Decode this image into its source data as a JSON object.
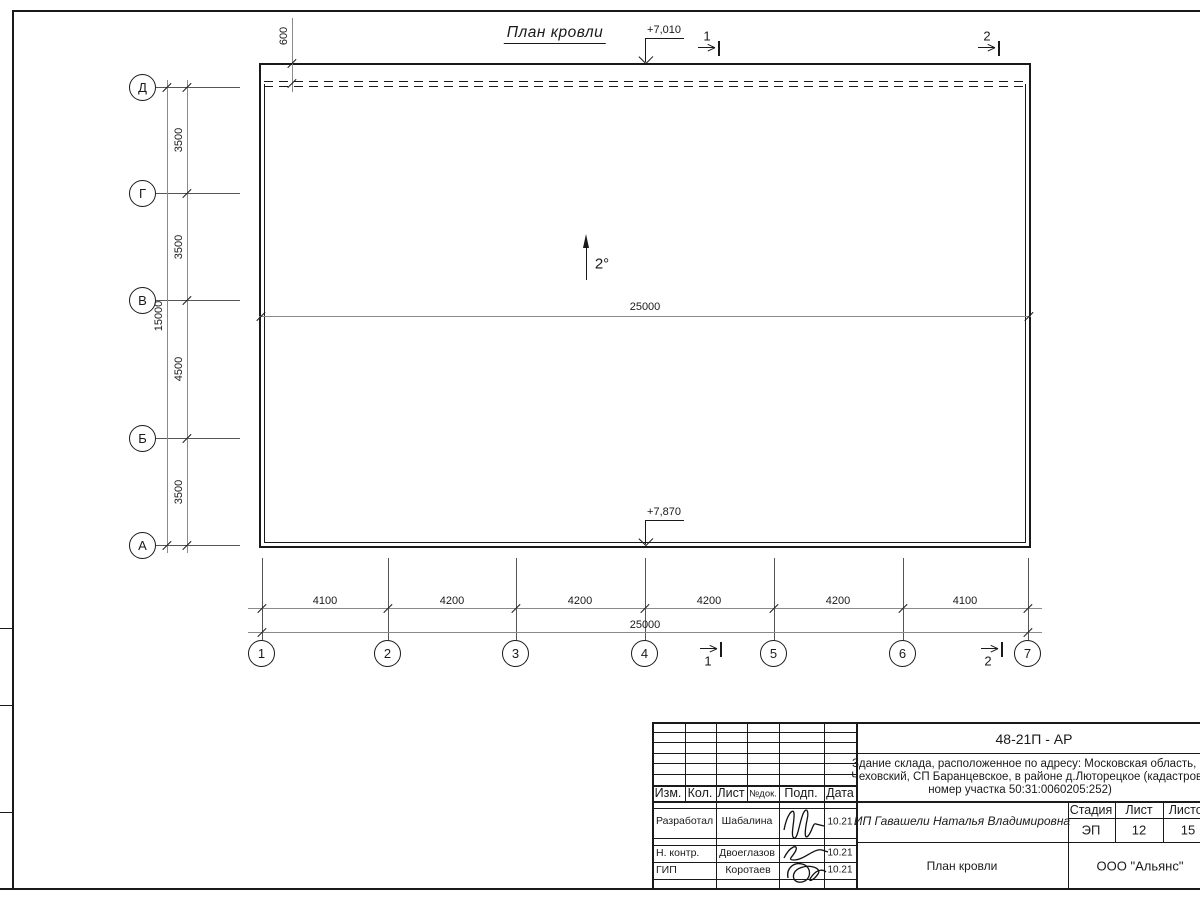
{
  "drawing": {
    "title": "План кровли",
    "slope_label": "2°",
    "ridge_dim": "25000",
    "roof_offset_dim": "600",
    "elevation_top": "+7,010",
    "elevation_bottom": "+7,870"
  },
  "axes": {
    "vertical_labels": [
      "Д",
      "Г",
      "В",
      "Б",
      "А"
    ],
    "vertical_dims": [
      "3500",
      "3500",
      "4500",
      "3500"
    ],
    "vertical_total": "15000",
    "horizontal_labels": [
      "1",
      "2",
      "3",
      "4",
      "5",
      "6",
      "7"
    ],
    "horizontal_dims": [
      "4100",
      "4200",
      "4200",
      "4200",
      "4200",
      "4100"
    ],
    "horizontal_total": "25000"
  },
  "sections": {
    "mark1": "1",
    "mark2": "2"
  },
  "title_block": {
    "doc_number": "48-21П - АР",
    "description_line1": "Здание склада, расположенное по адресу: Московская область, р-н",
    "description_line2": "Чеховский, СП Баранцевское, в районе д.Люторецкое  (кадастровый",
    "description_line3": "номер участка 50:31:0060205:252)",
    "header": {
      "izm": "Изм.",
      "kol": "Кол.",
      "list": "Лист",
      "ndok": "№док.",
      "podp": "Подп.",
      "data": "Дата"
    },
    "rows": [
      {
        "role": "Разработал",
        "name": "Шабалина",
        "date": "10.21"
      },
      {
        "role": "Н. контр.",
        "name": "Двоеглазов",
        "date": "10.21"
      },
      {
        "role": "ГИП",
        "name": "Коротаев",
        "date": "10.21"
      }
    ],
    "client": "ИП Гавашели Наталья Владимировна",
    "stage_label": "Стадия",
    "sheet_label": "Лист",
    "sheets_label": "Листов",
    "stage": "ЭП",
    "sheet": "12",
    "sheets": "15",
    "sheet_title": "План кровли",
    "company": "ООО \"Альянс\""
  },
  "colors": {
    "line": "#1a1a1a",
    "thin": "#8a8a8a",
    "background": "#ffffff"
  }
}
